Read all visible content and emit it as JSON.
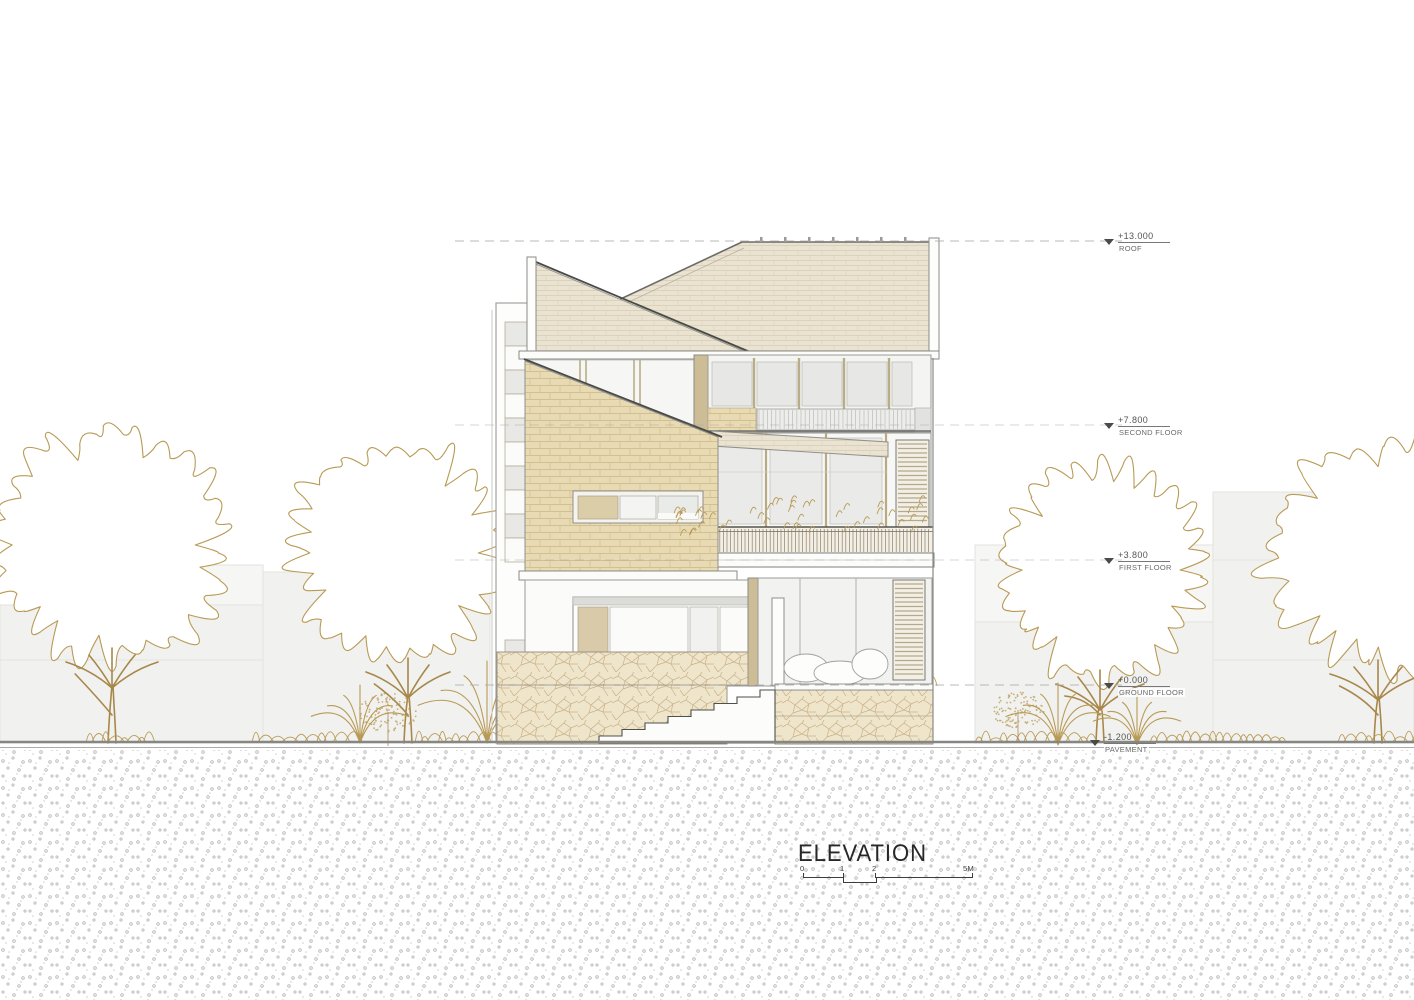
{
  "title": "ELEVATION",
  "drawing_type": "architectural elevation",
  "levels": [
    {
      "value": "+13.000",
      "name": "ROOF"
    },
    {
      "value": "+7.800",
      "name": "SECOND FLOOR"
    },
    {
      "value": "+3.800",
      "name": "FIRST FLOOR"
    },
    {
      "value": "+0.000",
      "name": "GROUND FLOOR"
    },
    {
      "value": "-1.200",
      "name": "PAVEMENT"
    }
  ],
  "scale_bar": {
    "ticks": [
      "0",
      "1",
      "2",
      "5M"
    ]
  },
  "colors": {
    "foliage_outline": "#b89a54",
    "trunk": "#a8874a",
    "brick": "#e8dab3",
    "shingle": "#ebe3d1",
    "stone": "#efe5cb",
    "glass": "#e9e9e7",
    "background_building": "#f1f1ef",
    "level_line": "#a8a8a8",
    "ink": "#2b2b2b"
  }
}
